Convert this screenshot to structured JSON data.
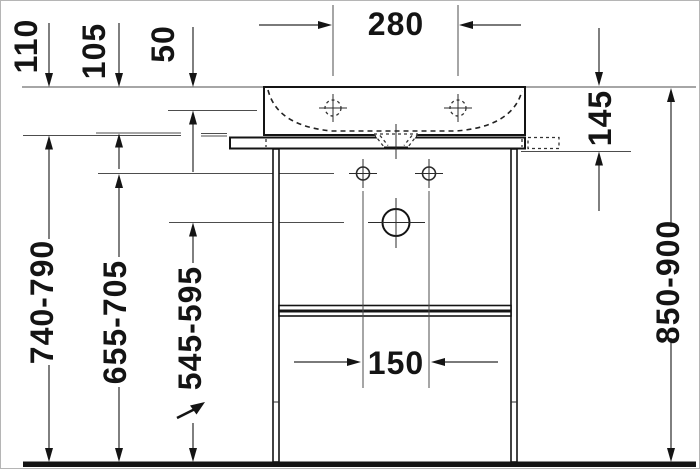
{
  "drawing": {
    "title": "Washbasin with metal console — front elevation, dimensioned",
    "dims": {
      "d110": "110",
      "d105": "105",
      "d50": "50",
      "d280": "280",
      "d145": "145",
      "d740": "740-790",
      "d655": "655-705",
      "d545": "545-595",
      "d850": "850-900",
      "d150": "150"
    }
  }
}
